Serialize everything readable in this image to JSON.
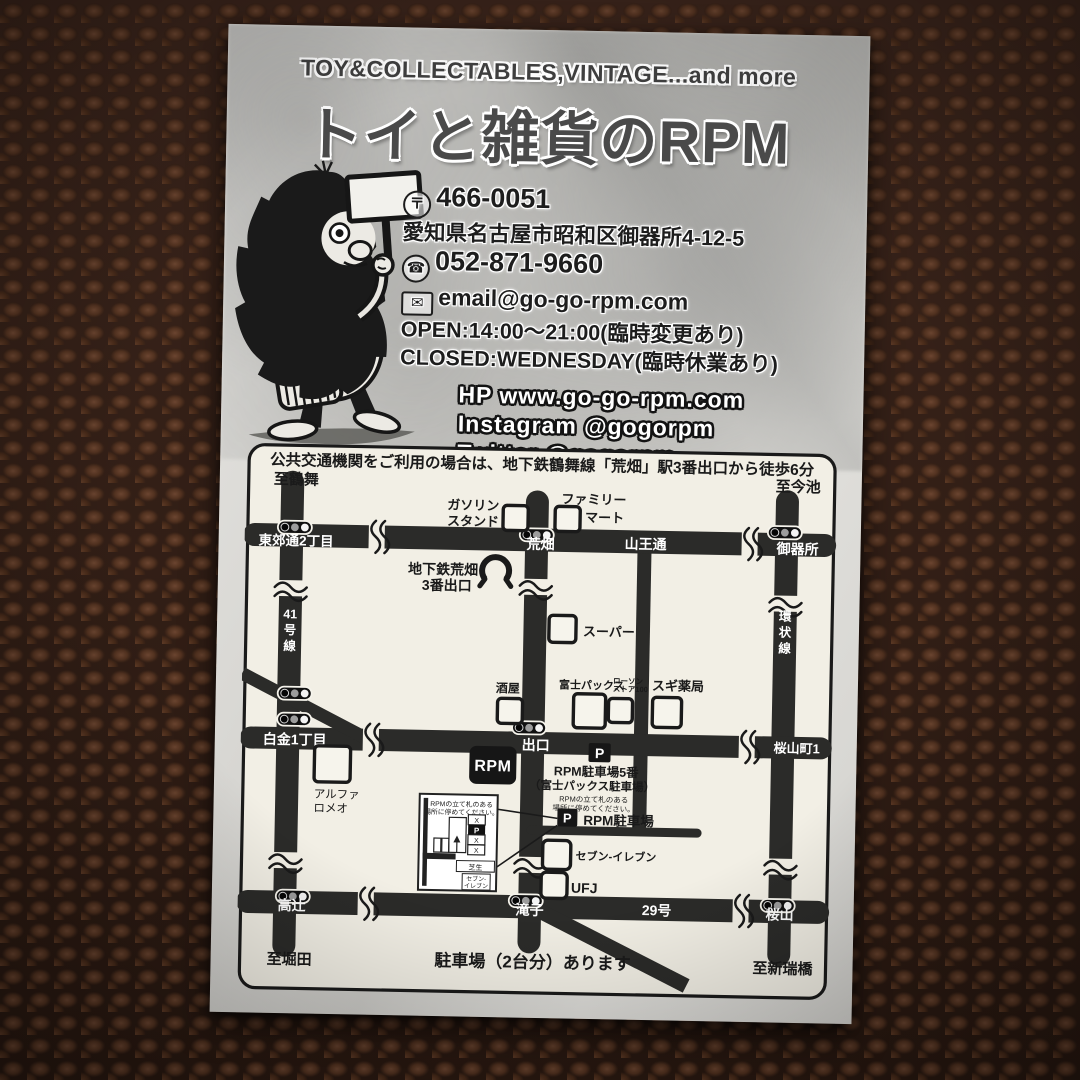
{
  "header": {
    "tagline": "TOY&COLLECTABLES,VINTAGE...and more",
    "title": "トイと雑貨のRPM"
  },
  "contact": {
    "postal_icon_glyph": "〒",
    "postal_code": "466-0051",
    "address": "愛知県名古屋市昭和区御器所4-12-5",
    "phone_icon_glyph": "☎",
    "phone": "052-871-9660",
    "mail_icon_glyph": "✉",
    "email": "email@go-go-rpm.com",
    "open": "OPEN:14:00～21:00(臨時変更あり)",
    "closed": "CLOSED:WEDNESDAY(臨時休業あり)"
  },
  "social": {
    "hp": "HP www.go-go-rpm.com",
    "instagram": "Instagram @gogorpm",
    "twitter": "Twitter @gogorpm"
  },
  "map": {
    "note": "公共交通機関をご利用の場合は、地下鉄鶴舞線「荒畑」駅3番出口から徒歩6分",
    "footer": "駐車場（2台分）あります",
    "dest_nw": "至鶴舞",
    "dest_ne": "至今池",
    "dest_sw": "至堀田",
    "dest_se": "至新瑞橋",
    "tokogo": "東郊通2丁目",
    "arahata": "荒畑",
    "sanno": "山王通",
    "gokiso": "御器所",
    "shirogane": "白金1丁目",
    "deguchi": "出口",
    "sakurayamacho": "桜山町1",
    "takatsuji": "高辻",
    "takiko": "滝子",
    "route29": "29号",
    "sakurayama": "桜山",
    "route41": [
      "41",
      "号",
      "線"
    ],
    "kanjosen": [
      "環",
      "状",
      "線"
    ],
    "gas1": "ガソリン",
    "gas2": "スタンド",
    "famima1": "ファミリー",
    "famima2": "マート",
    "subway1": "地下鉄荒畑",
    "subway2": "3番出口",
    "supermarket": "スーパー",
    "sakaya": "酒屋",
    "fujipax": "富士パックス",
    "lawson1": "ローソン",
    "lawson2": "ストア100",
    "sugi": "スギ薬局",
    "alfa1": "アルファ",
    "alfa2": "ロメオ",
    "rpm_logo": "RPM",
    "p": "P",
    "parking5_1": "RPM駐車場5番",
    "parking5_2": "（富士パックス駐車場）",
    "parking5_3": "RPMの立て札のある",
    "parking5_4": "場所に停めてください。",
    "parking_label": "RPM駐車場",
    "seven": "セブン-イレブン",
    "ufj": "UFJ",
    "inset": {
      "note1": "RPMの立て札のある",
      "note2": "場所に停めてください。",
      "x": "X",
      "p": "P",
      "shibafu": "芝生",
      "seven1": "セブン-",
      "seven2": "イレブン"
    }
  }
}
